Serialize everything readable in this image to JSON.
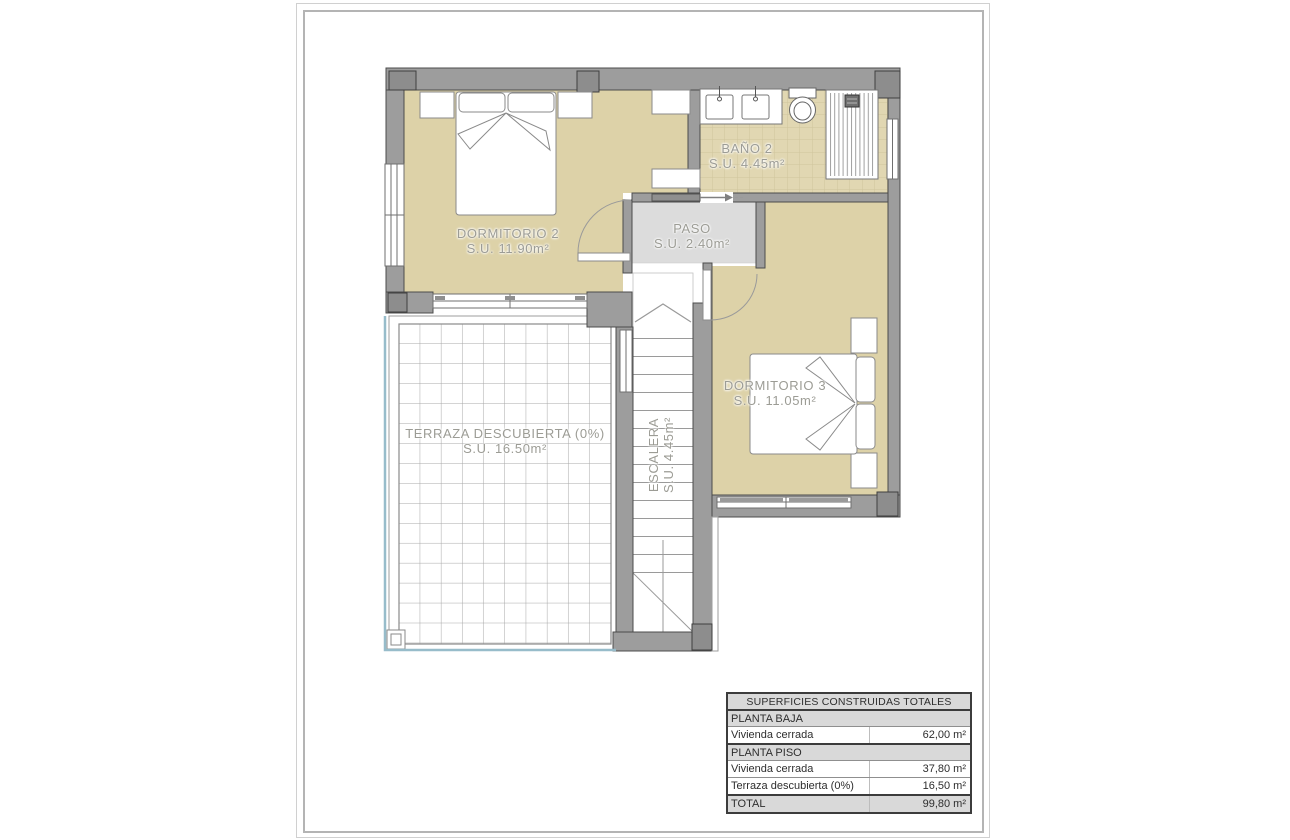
{
  "plan": {
    "rooms": [
      {
        "id": "dormitorio2",
        "name": "DORMITORIO 2",
        "area": "S.U. 11.90m²"
      },
      {
        "id": "bano2",
        "name": "BAÑO 2",
        "area": "S.U. 4.45m²"
      },
      {
        "id": "paso",
        "name": "PASO",
        "area": "S.U. 2.40m²"
      },
      {
        "id": "dormitorio3",
        "name": "DORMITORIO 3",
        "area": "S.U. 11.05m²"
      },
      {
        "id": "terraza",
        "name": "TERRAZA DESCUBIERTA (0%)",
        "area": "S.U. 16.50m²"
      },
      {
        "id": "escalera",
        "name": "ESCALERA",
        "area": "S.U. 4.45m²"
      }
    ],
    "colors": {
      "floor_beige": "#ddd2a8",
      "bath_tile": "#e1d7b2",
      "hall_gray": "#dcdcdc",
      "wall_gray": "#9d9d9d",
      "pool_edge_blue": "#97bcca",
      "label_gray": "#9c9c95"
    }
  },
  "summary_table": {
    "title": "SUPERFICIES CONSTRUIDAS TOTALES",
    "sections": [
      {
        "header": "PLANTA BAJA",
        "rows": [
          {
            "label": "Vivienda cerrada",
            "value": "62,00 m²"
          }
        ]
      },
      {
        "header": "PLANTA PISO",
        "rows": [
          {
            "label": "Vivienda cerrada",
            "value": "37,80 m²"
          },
          {
            "label": "Terraza descubierta (0%)",
            "value": "16,50 m²"
          }
        ]
      }
    ],
    "total": {
      "label": "TOTAL",
      "value": "99,80 m²"
    }
  }
}
